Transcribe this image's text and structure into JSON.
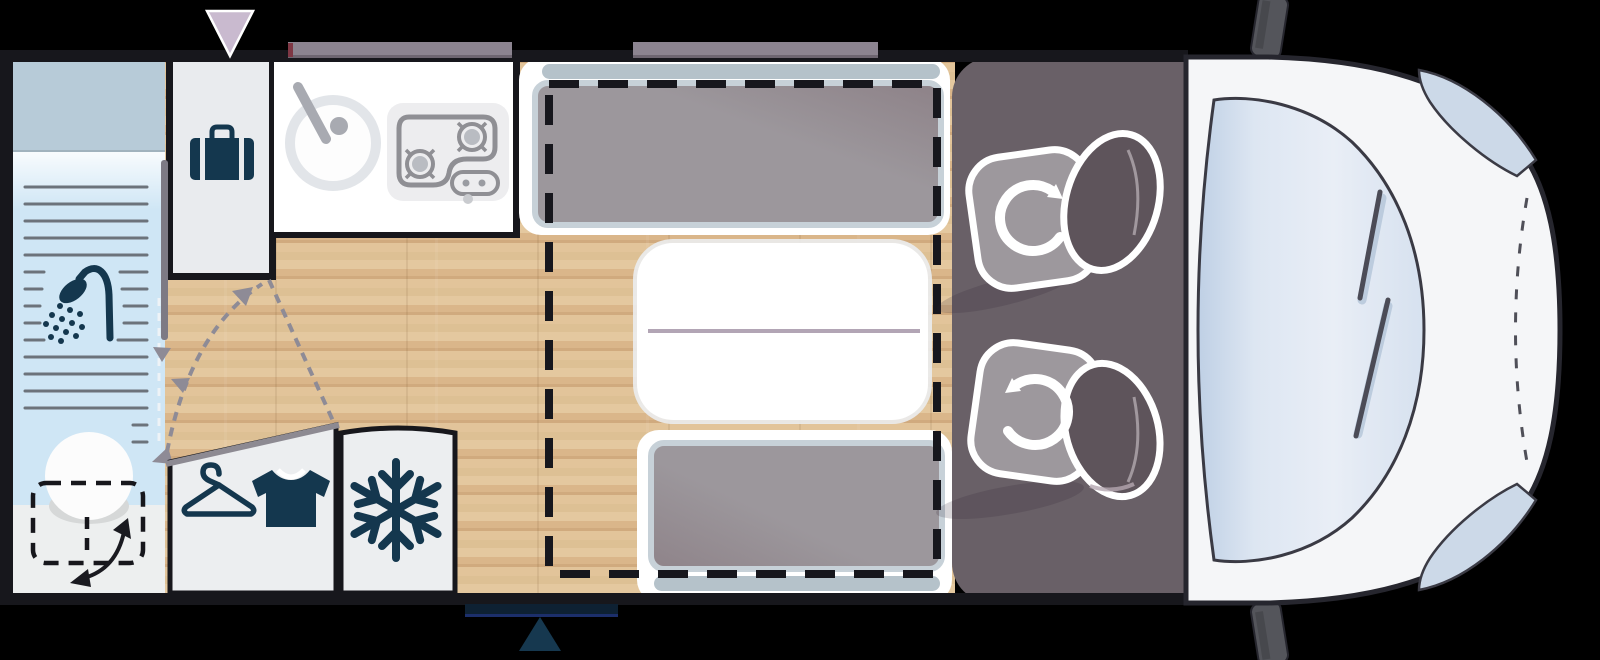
{
  "palette": {
    "background": "#000000",
    "wall": "#17171c",
    "wood_light": "#e4c89f",
    "wood_dark": "#d0aa7e",
    "icon_navy": "#14374e",
    "shower_blue": "#cfe6f5",
    "cabinet_blue_gray": "#b7cbd8",
    "bathroom_floor_gray": "#edefef",
    "unit_gray": "#eceef0",
    "cab_floor": "#696067",
    "seat_cushion": "#9d989d",
    "seat_back": "#5e545b",
    "bench_cushion": "#9c979c",
    "headrest_blue": "#b5c2ca",
    "table_line": "#b2a5b5",
    "window_bar": "#8c8490",
    "vent_lavender": "#c9bacf",
    "entry_step": "#0e2133",
    "entry_arrow": "#16384f",
    "body_white": "#f5f6f8",
    "glass_blue": "#d5dfee",
    "dash_dark": "#17171d",
    "swing_gray": "#8e8b96"
  },
  "floorplan": {
    "vehicle": "campervan-top-view",
    "zones": [
      {
        "id": "bathroom",
        "fixtures": [
          "overhead-locker",
          "shower-tray",
          "shower-head",
          "pivoting-door",
          "swivel-toilet"
        ]
      },
      {
        "id": "storage-cabinet",
        "icon": "suitcase-icon"
      },
      {
        "id": "kitchen",
        "fixtures": [
          "round-sink",
          "two-burner-hob"
        ]
      },
      {
        "id": "wardrobe",
        "icons": [
          "hanger-icon",
          "tshirt-icon"
        ]
      },
      {
        "id": "fridge",
        "icon": "snowflake-icon"
      },
      {
        "id": "dinette",
        "fixtures": [
          "bench-seat-front",
          "folding-table",
          "bench-seat-rear",
          "drop-down-bed-outline"
        ]
      },
      {
        "id": "cab",
        "fixtures": [
          "swivel-seat-passenger",
          "swivel-seat-driver",
          "windshield",
          "wing-mirror-left",
          "wing-mirror-right",
          "headlight-left",
          "headlight-right",
          "bonnet-line"
        ]
      }
    ],
    "markers": [
      "roof-vent-marker",
      "window-over-kitchen",
      "window-over-dinette",
      "entry-step",
      "entrance-arrow"
    ]
  }
}
